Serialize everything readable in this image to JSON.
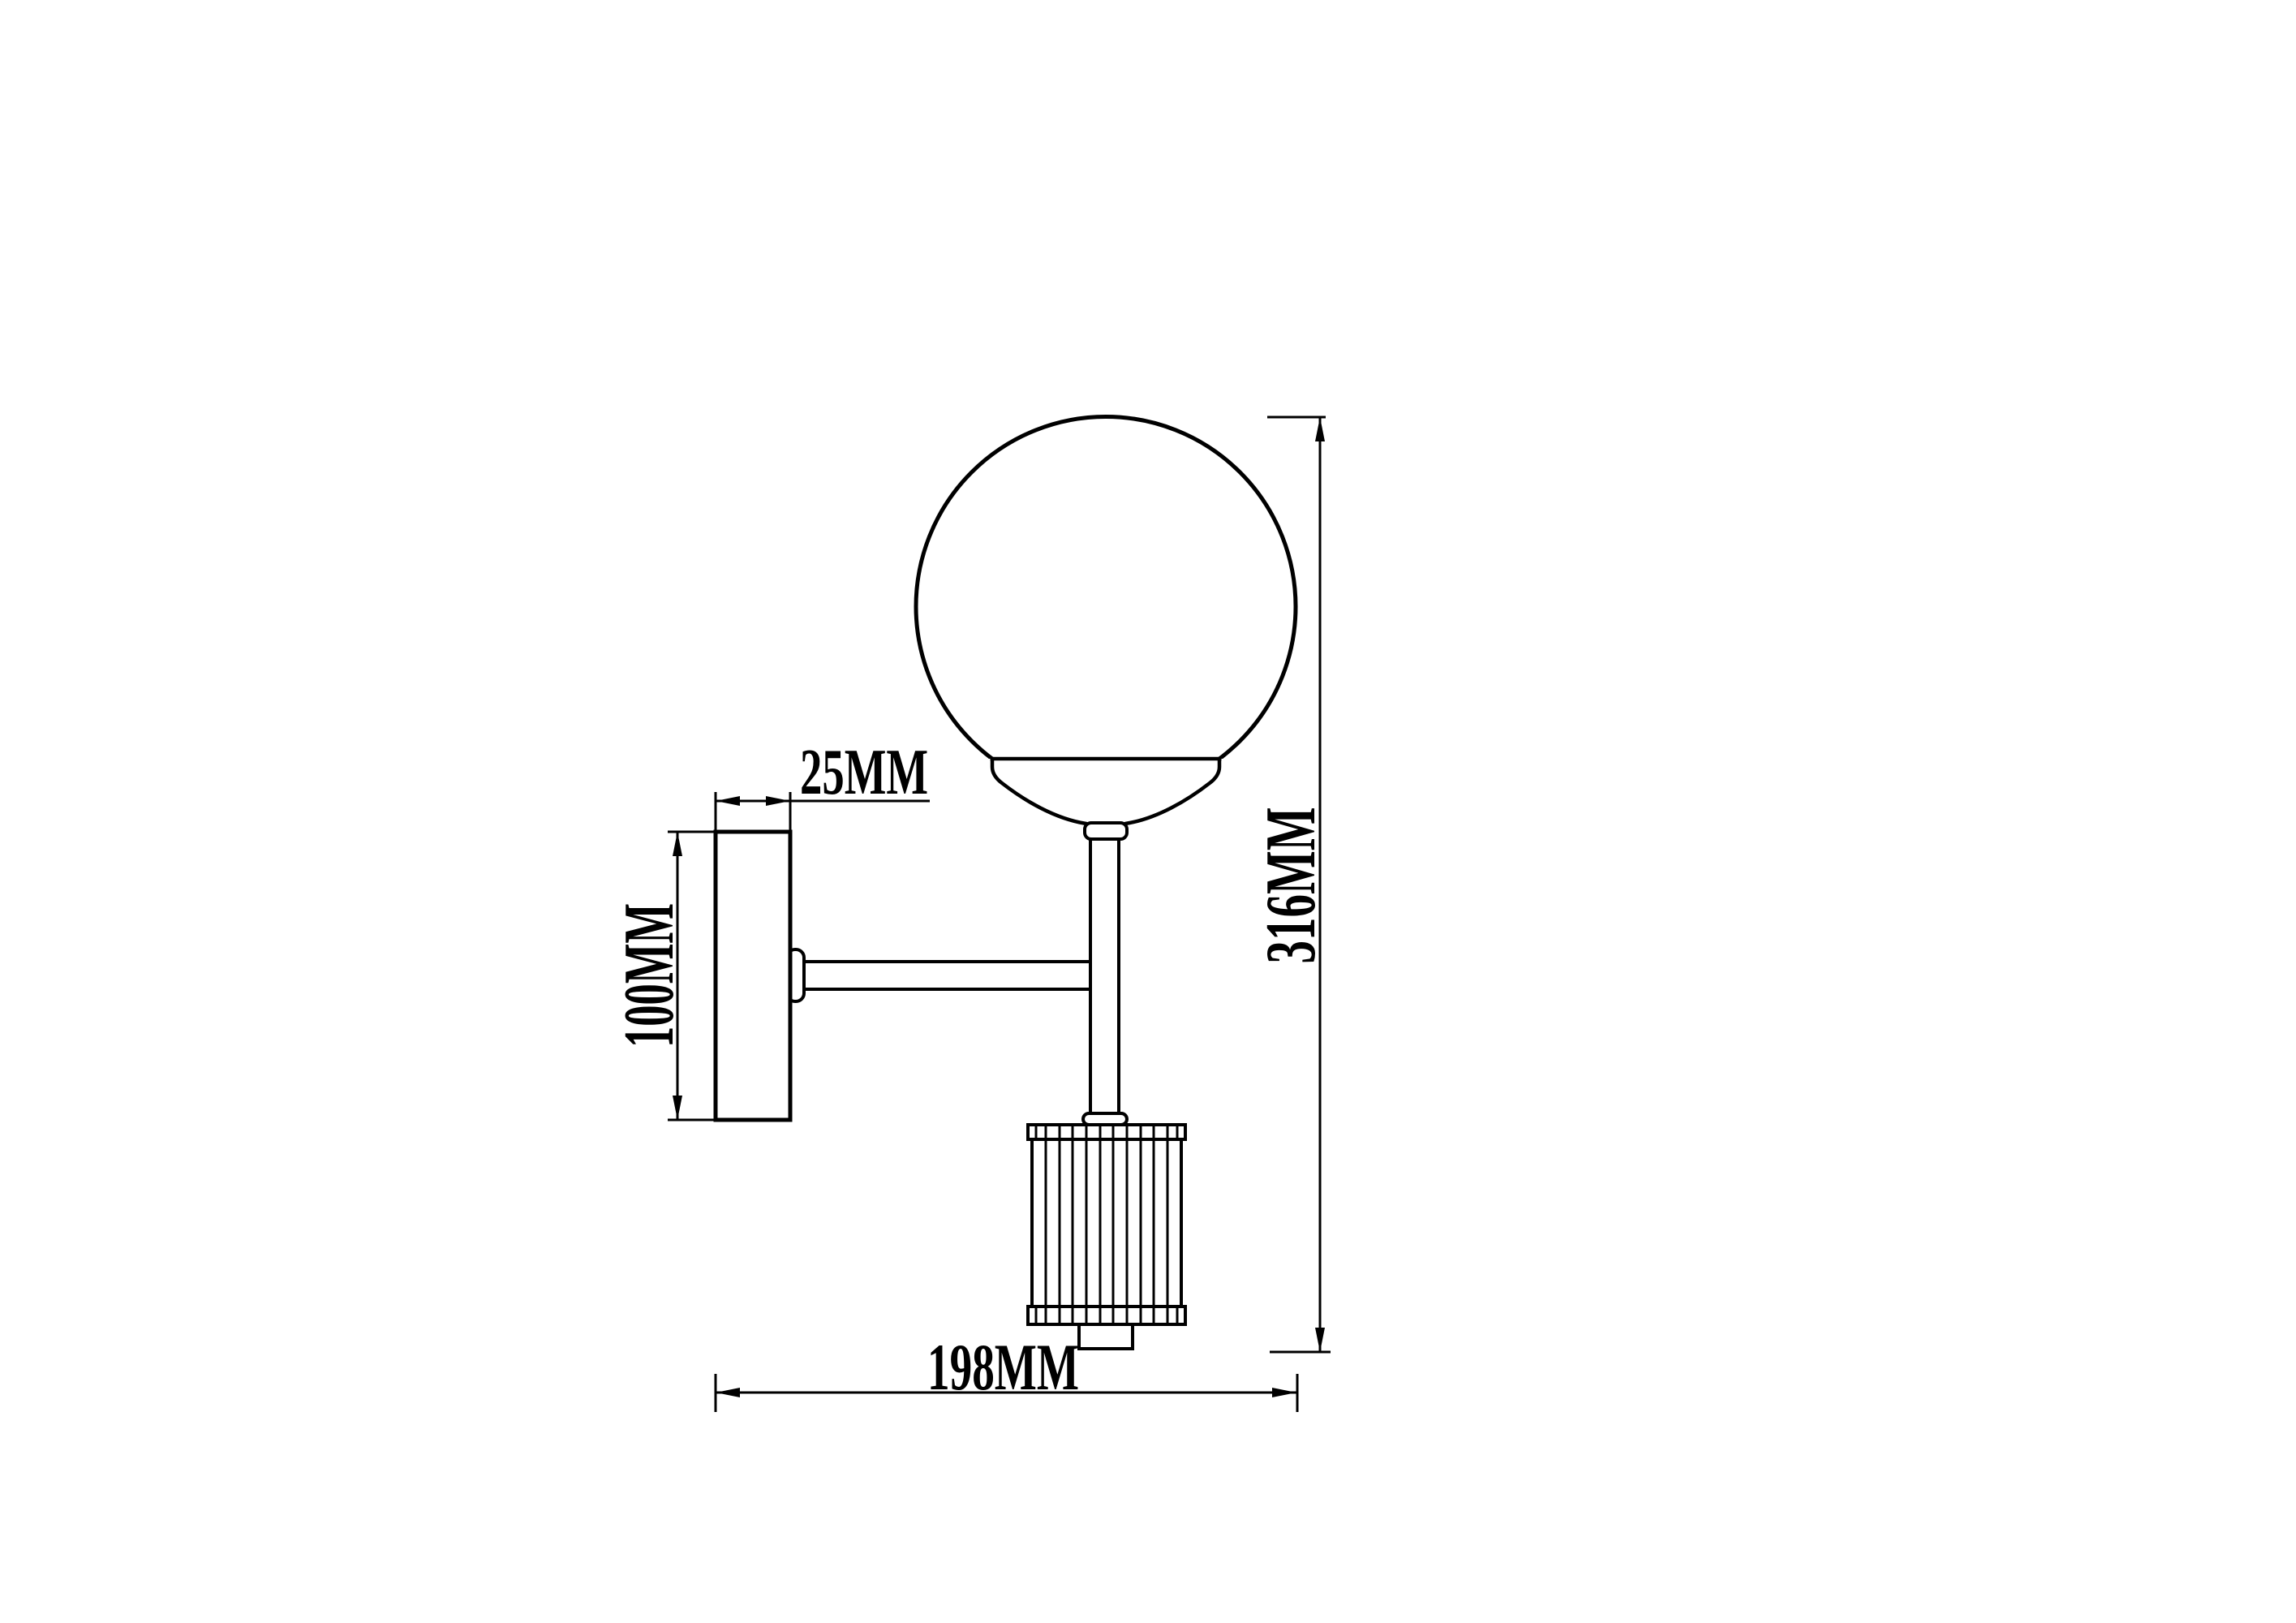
{
  "page": {
    "background_color": "#ffffff",
    "line_color": "#000000"
  },
  "drawing": {
    "units": "MM",
    "labels": {
      "backplate_depth": "25MM",
      "backplate_height": "100MM",
      "overall_height": "316MM",
      "overall_width": "198MM"
    }
  }
}
